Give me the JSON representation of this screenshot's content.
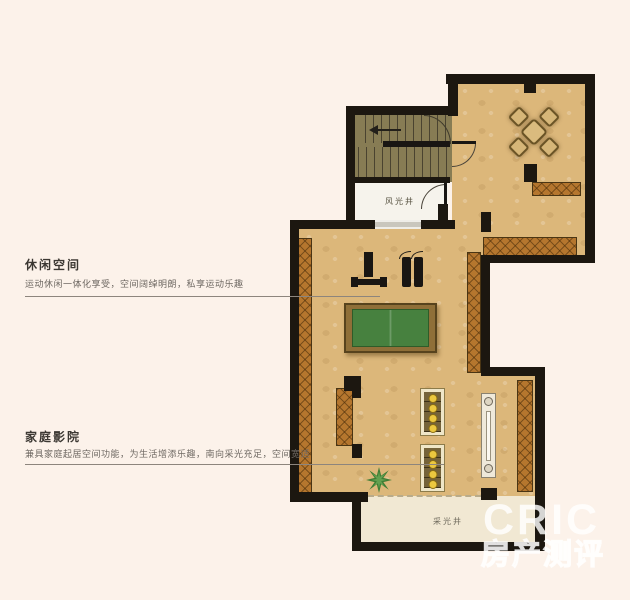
{
  "annotations": {
    "leisure": {
      "title": "休闲空间",
      "description": "运动休闲一体化享受，空间阔绰明朗，私享运动乐趣"
    },
    "home_theater": {
      "title": "家庭影院",
      "description": "兼具家庭起居空间功能，为生活增添乐趣，南向采光充足，空间宽适"
    }
  },
  "plan_labels": {
    "wind_light_well": "风光井",
    "daylight_well": "采光井"
  },
  "watermark": {
    "logo": "CRIC",
    "tagline": "房产测评"
  },
  "colors": {
    "background": "#fcf2ea",
    "floor_tan": "#dcb77a",
    "wall_black": "#1c1710",
    "stair_room_olive": "#877c54",
    "pool_table_green": "#47813f",
    "wood_hatch": "#b5762e",
    "seat_dot_yellow": "#ecc83f"
  }
}
